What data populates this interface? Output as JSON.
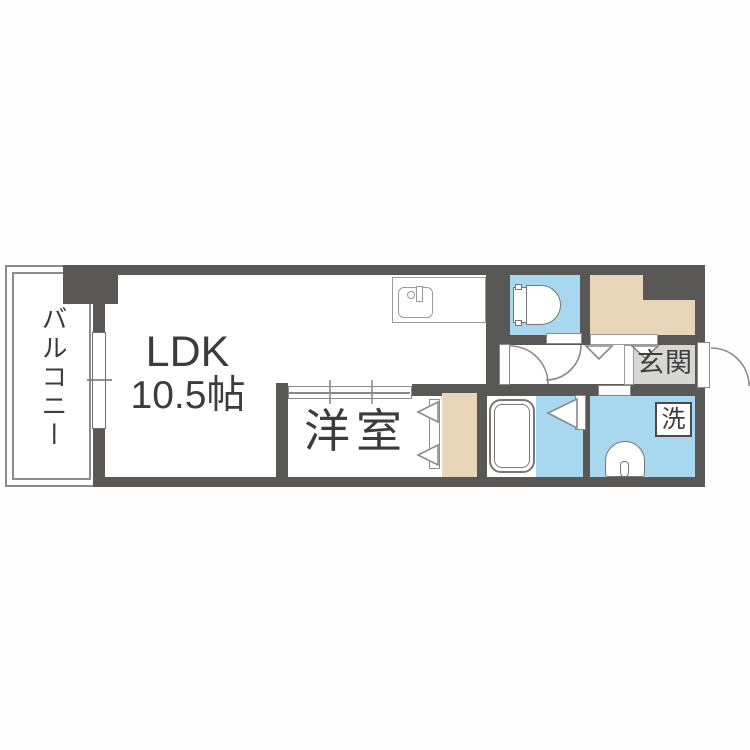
{
  "plan": {
    "title": "apartment-floor-plan",
    "labels": {
      "balcony": "バルコニー",
      "ldk_line1": "LDK",
      "ldk_line2": "10.5帖",
      "western_room": "洋室",
      "entrance": "玄関",
      "laundry": "洗"
    },
    "rooms": [
      {
        "name": "balcony",
        "label": "バルコニー"
      },
      {
        "name": "ldk",
        "label": "LDK 10.5帖"
      },
      {
        "name": "western-room",
        "label": "洋室"
      },
      {
        "name": "toilet-room",
        "label": ""
      },
      {
        "name": "bathroom",
        "label": ""
      },
      {
        "name": "washroom",
        "label": "洗"
      },
      {
        "name": "entrance",
        "label": "玄関"
      },
      {
        "name": "closet",
        "label": ""
      }
    ],
    "colors": {
      "wall": "#595857",
      "water_area": "#a8d7f0",
      "closet": "#e9d6ba",
      "entrance_floor": "#d7d7d6",
      "floor": "#ffffff",
      "fixture_outline": "#848484",
      "text": "#3c3c3c"
    },
    "icons": [
      "window-icon",
      "sliding-door-icon",
      "kitchen-sink-icon",
      "toilet-icon",
      "bathtub-icon",
      "washbasin-icon",
      "door-swing-icon",
      "folding-door-icon"
    ]
  }
}
